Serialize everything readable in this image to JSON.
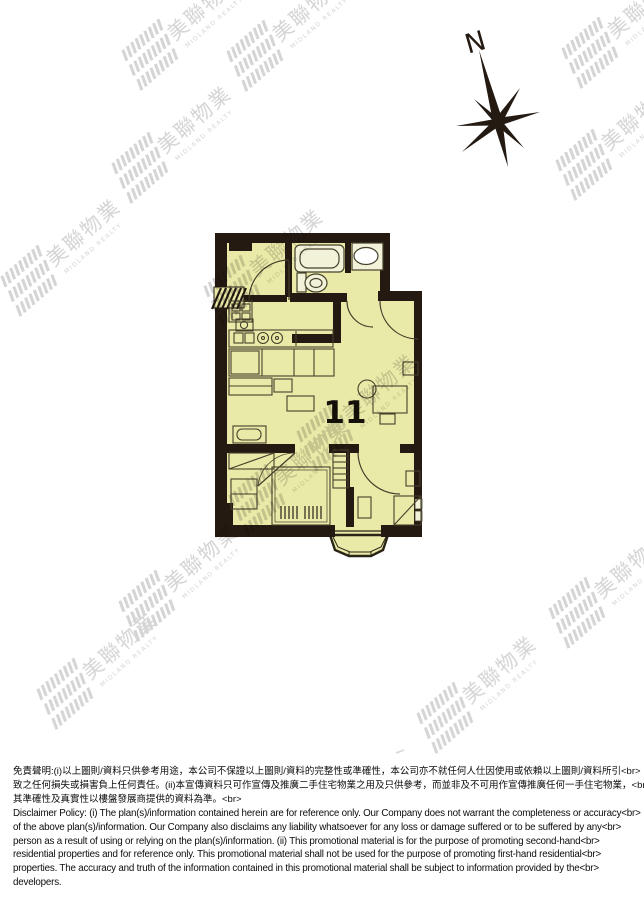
{
  "page": {
    "background": "#ffffff"
  },
  "compass": {
    "label": "N"
  },
  "floor_plan": {
    "unit_number": "11",
    "room_fill": "#eaeaa8",
    "wall_color": "#241a12",
    "line_color": "#45402c",
    "fixture_fill": "#f2f2d8"
  },
  "watermark": {
    "cn": "美聯物業",
    "en": "MIDLAND REALTY",
    "color": "#d0d0d0"
  },
  "disclaimer": {
    "lines": [
      "免責聲明:(i)以上圖則/資料只供參考用途，本公司不保證以上圖則/資料的完整性或準確性，本公司亦不就任何人仕因使用或依賴以上圖則/資料所引<br>",
      "致之任何損失或損害負上任何責任。(ii)本宣傳資料只可作宣傳及推廣二手住宅物業之用及只供參考，而並非及不可用作宣傳推廣任何一手住宅物業，<br>",
      "其準確性及真實性以樓盤發展商提供的資料為準。<br>",
      "Disclaimer Policy: (i) The plan(s)/information contained herein are for reference only. Our Company does not warrant the completeness or accuracy<br>",
      "of the above plan(s)/information. Our Company also disclaims any liability whatsoever for any loss or damage suffered or to be suffered by any<br>",
      "person as a result of using or relying on the plan(s)/information. (ii) This promotional material is for the purpose of promoting second-hand<br>",
      "residential properties and for reference only. This promotional material shall not be used for the purpose of promoting first-hand residential<br>",
      "properties. The accuracy and truth of the information contained in this promotional material shall be subject to information provided by the<br>",
      "developers."
    ]
  }
}
